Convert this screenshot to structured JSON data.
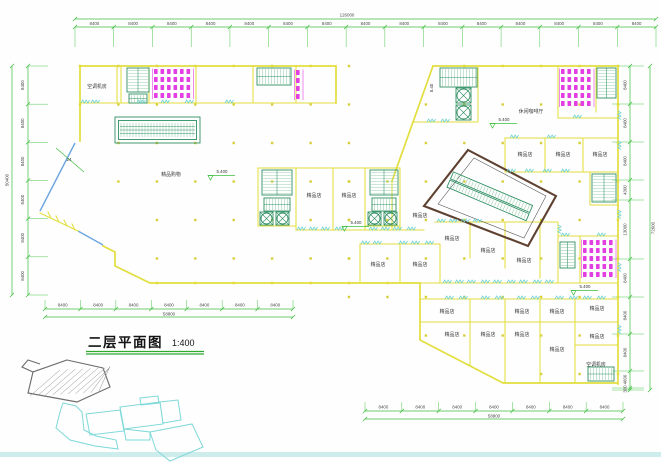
{
  "title_block": {
    "title": "二层平面图",
    "scale": "1:400"
  },
  "drawing": {
    "room_labels": [
      {
        "text": "空调机房",
        "x": 97,
        "y": 88
      },
      {
        "text": "精品购物",
        "x": 171,
        "y": 176
      },
      {
        "text": "休闲咖啡厅",
        "x": 531,
        "y": 113
      },
      {
        "text": "精品店",
        "x": 314,
        "y": 197
      },
      {
        "text": "精品店",
        "x": 349,
        "y": 197
      },
      {
        "text": "精品店",
        "x": 420,
        "y": 217
      },
      {
        "text": "精品店",
        "x": 525,
        "y": 156
      },
      {
        "text": "精品店",
        "x": 563,
        "y": 156
      },
      {
        "text": "精品店",
        "x": 600,
        "y": 156
      },
      {
        "text": "精品店",
        "x": 378,
        "y": 266
      },
      {
        "text": "精品店",
        "x": 420,
        "y": 266
      },
      {
        "text": "精品店",
        "x": 452,
        "y": 240
      },
      {
        "text": "精品店",
        "x": 488,
        "y": 252
      },
      {
        "text": "精品店",
        "x": 524,
        "y": 262
      },
      {
        "text": "精品店",
        "x": 447,
        "y": 313
      },
      {
        "text": "精品店",
        "x": 522,
        "y": 313
      },
      {
        "text": "精品店",
        "x": 557,
        "y": 313
      },
      {
        "text": "精品店",
        "x": 597,
        "y": 310
      },
      {
        "text": "精品店",
        "x": 452,
        "y": 336
      },
      {
        "text": "精品店",
        "x": 488,
        "y": 336
      },
      {
        "text": "精品店",
        "x": 522,
        "y": 336
      },
      {
        "text": "精品店",
        "x": 557,
        "y": 351
      },
      {
        "text": "精品店",
        "x": 597,
        "y": 338
      },
      {
        "text": "空调机房",
        "x": 596,
        "y": 366
      }
    ],
    "elevation_marks": [
      {
        "text": "5.400",
        "x": 218,
        "y": 173
      },
      {
        "text": "5.400",
        "x": 500,
        "y": 121
      },
      {
        "text": "5.400",
        "x": 352,
        "y": 224
      },
      {
        "text": "5.400",
        "x": 581,
        "y": 288
      },
      {
        "text": "5.40",
        "x": 429,
        "y": 88,
        "rotated": true
      }
    ],
    "annotations": [
      {
        "text": "24",
        "x": 69,
        "y": 161
      }
    ],
    "dimensions": {
      "top": {
        "total": "126000",
        "segment": "8400",
        "count": 15
      },
      "left": {
        "total": "50400",
        "segment": "8400",
        "count": 6
      },
      "right": {
        "total": "72600",
        "segments": [
          "8400",
          "8400",
          "8400",
          "4300",
          "13000",
          "8400",
          "8400",
          "8400",
          "4600",
          "300"
        ]
      },
      "bottom_left": {
        "total": "58800",
        "segment": "8400",
        "count": 7
      },
      "bottom_right": {
        "total": "58800",
        "segment": "8400",
        "count": 7
      }
    },
    "colors": {
      "wall": "#e2de3e",
      "dimension": "#3dbe3d",
      "dim_text": "#4a4a4a",
      "door": "#6fd1d1",
      "stair": "#2f8f62",
      "stair_light": "#9ccfaf",
      "fixture": "#e23ee2",
      "atrium": "#5e4130",
      "glazing": "#6ca6e0",
      "site": "#7fd8d8",
      "band": "#cdecec",
      "column": "#d6cf3a",
      "underline": "#2fa82f"
    }
  }
}
